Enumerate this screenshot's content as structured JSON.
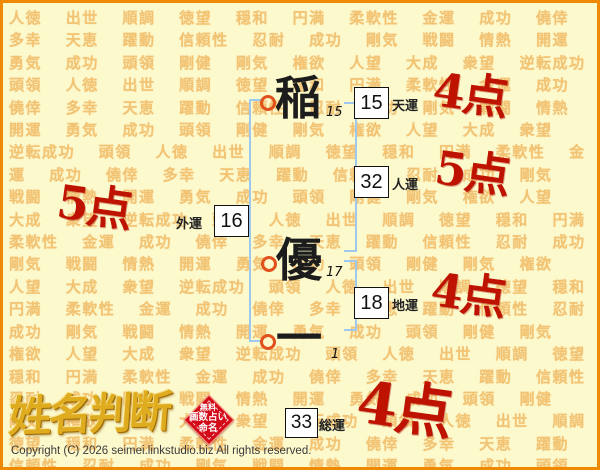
{
  "background_words": [
    "人徳",
    "出世",
    "順調",
    "徳望",
    "穏和",
    "円満",
    "柔軟性",
    "金運",
    "成功",
    "僥倖",
    "多幸",
    "天恵",
    "躍動",
    "信頼性",
    "忍耐",
    "成功",
    "剛気",
    "戦闘",
    "情熱",
    "開運",
    "勇気",
    "成功",
    "頭領",
    "剛健",
    "剛気",
    "権欲",
    "人望",
    "大成",
    "衆望",
    "逆転成功",
    "頭領"
  ],
  "name": {
    "characters": [
      {
        "char": "稲",
        "strokes": "15"
      },
      {
        "char": "優",
        "strokes": "17"
      },
      {
        "char": "一",
        "strokes": "1"
      }
    ]
  },
  "fortunes": [
    {
      "label": "天運",
      "value": "15",
      "score": "4点"
    },
    {
      "label": "人運",
      "value": "32",
      "score": "5点"
    },
    {
      "label": "外運",
      "value": "16",
      "score": "5点"
    },
    {
      "label": "地運",
      "value": "18",
      "score": "4点"
    },
    {
      "label": "総運",
      "value": "33",
      "score": "4点"
    }
  ],
  "logo": {
    "title": "姓名判断",
    "badge_lines": [
      "無料",
      "画数占い",
      "命名"
    ]
  },
  "footer": {
    "copyright": "Copyright (C) 2026 seimei.linkstudio.biz All rights reserved."
  },
  "colors": {
    "border_orange": "#ef8a00",
    "background_yellow": "#fcf9cd",
    "background_word_orange": "#f0b45a",
    "bracket_blue": "#9fc8ee",
    "ring_orange": "#e0511c",
    "score_red": "#bd1300",
    "badge_red": "#d30a18",
    "logo_gold": "#dfac20"
  }
}
